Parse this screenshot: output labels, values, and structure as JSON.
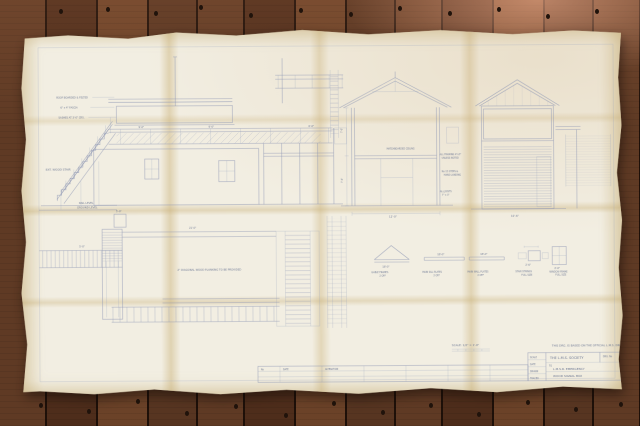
{
  "palette": {
    "floor_dark": "#4e2d1b",
    "floor_mid": "#6b4228",
    "paper": "#f2eee2",
    "fold_tint": "#c4a868",
    "line_blue": "#8e97b4"
  },
  "drawing": {
    "datum": {
      "rail": "RAIL LEVEL",
      "ground": "GROUND LEVEL"
    },
    "stair_label": "EXT. WOOD STAIR",
    "elevation_notes": {
      "roof": "ROOF BOARDED & FELTED",
      "fascia": "6\" x 4\" FASCIA",
      "sash": "SASHES AT 3'-0\" CRS."
    },
    "section": {
      "ceiling_note": "MATCHBOARDED CEILING",
      "note_1a": "ALL FRAMING 4\"x3\"",
      "note_1b": "UNLESS NOTED",
      "note_2a": "No 15 STEPS &",
      "note_2b": "HAND LANDING",
      "note_3a": "ALL JOISTS",
      "note_3b": "7\" x 3\""
    },
    "plan": {
      "planking_note": "2\" DIAGONAL WOOD PLANKING TO BE PROVIDED"
    },
    "dims": {
      "section_width": "12'-0\"",
      "section_h1": "7'-0\"",
      "section_h2": "7'-6\"",
      "end_width": "10'-6\"",
      "plan_run": "21'-0\"",
      "plan_flight": "5'-0\"",
      "plan_upper": "5'-9\"",
      "walk_a": "9'-0\"",
      "walk_b": "9'-0\"",
      "walk_c": "6'-0\""
    },
    "details": [
      {
        "label1": "GABLE FRAMES",
        "label2": "2 OFF",
        "dim": "18'-0\""
      },
      {
        "label1": "MAIN SILL PLATES",
        "label2": "2 OFF",
        "dim": "18'-0\""
      },
      {
        "label1": "MAIN WALL PLATES",
        "label2": "2 OFF",
        "dim": "18'-0\""
      },
      {
        "label1": "STAIR STRINGS",
        "label2": "FULL SIZE",
        "dim": "2'-6\""
      },
      {
        "label1": "WINDOW FRAME",
        "label2": "FULL SIZE",
        "dim": "2'-0\""
      }
    ],
    "scale_note": "SCALE: 1/2\" = 1'-0\"",
    "based_note": "THIS DRG. IS BASED ON THE OFFICIAL L.M.S. DRG.",
    "title_block": {
      "society": "THE L.M.S. SOCIETY",
      "to": "TO",
      "subject": "L.M.S.R. EMERGENCY",
      "subtitle": "WOOD SIGNAL BOX",
      "row_1": "SCALE",
      "row_2": "DATE",
      "row_3": "DRAWN",
      "row_4": "TRACED",
      "drg_label": "DRG. No"
    },
    "revision": {
      "h1": "No",
      "h2": "DATE",
      "h3": "ALTERATION"
    }
  }
}
